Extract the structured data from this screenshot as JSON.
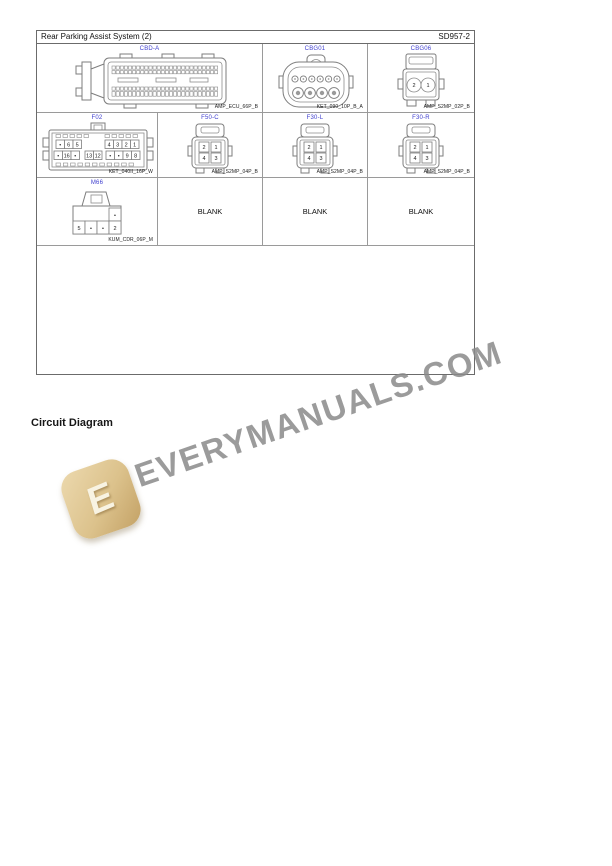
{
  "page": {
    "header": {
      "title": "Rear Parking Assist System (2)",
      "code": "SD957-2"
    },
    "section_label": "Circuit Diagram",
    "blank_label": "BLANK",
    "watermark": {
      "text": "EVERYMANUALS.COM",
      "logo_letter": "E",
      "text_color": "#8a8a8a",
      "logo_color": "#dcc28c"
    },
    "accent_label_color": "#4040cf"
  },
  "connectors": {
    "cbd_a": {
      "label": "CBD-A",
      "part": "AMP_ECU_66P_B"
    },
    "cbg01": {
      "label": "CBG01",
      "part": "KET_090_10P_B_A"
    },
    "cbg06": {
      "label": "CBG06",
      "part": "AMP_S2MP_02P_B",
      "pins": [
        "2",
        "1"
      ]
    },
    "f02": {
      "label": "F02",
      "part": "KET_040II_16P_W",
      "pins_top": [
        "•",
        "6",
        "5",
        "4",
        "3",
        "2",
        "1"
      ],
      "pins_bottom": [
        "•",
        "16",
        "•",
        "13",
        "12",
        "•",
        "•",
        "9",
        "8"
      ]
    },
    "f50_c": {
      "label": "F50-C",
      "part": "AMP_S2MP_04P_B",
      "pins": [
        "2",
        "1",
        "4",
        "3"
      ]
    },
    "f30_l": {
      "label": "F30-L",
      "part": "AMP_S2MP_04P_B",
      "pins": [
        "2",
        "1",
        "4",
        "3"
      ]
    },
    "f30_r": {
      "label": "F30-R",
      "part": "AMP_S2MP_04P_B",
      "pins": [
        "2",
        "1",
        "4",
        "3"
      ]
    },
    "m66": {
      "label": "M66",
      "part": "KUM_CDR_06P_M",
      "pins_top": [
        "•"
      ],
      "pins_bottom": [
        "5",
        "•",
        "•",
        "2"
      ]
    }
  }
}
